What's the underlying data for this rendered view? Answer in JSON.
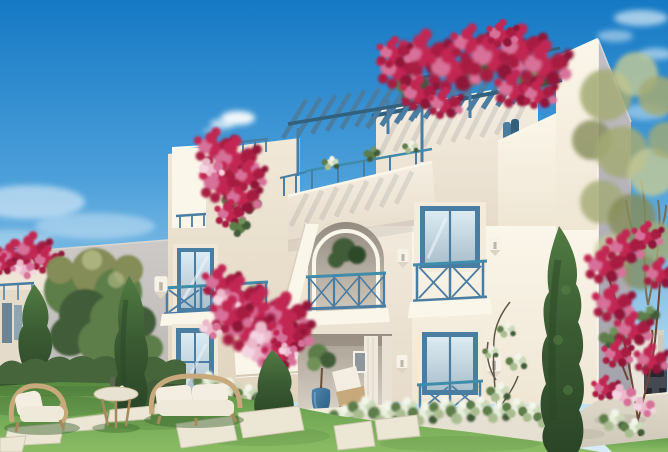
{
  "scene": {
    "type": "exterior-architectural-rendering",
    "subject": "White Cycladic-style two-storey residence with blue pergolas, bougainvillea, arched balcony, garden lawn, wicker seating and stepping-stone path under a clear blue sky",
    "elements": [
      "sky",
      "clouds",
      "neighbor-building-left",
      "neighbor-rooftop-pergola",
      "boundary-wall",
      "leafy-tree",
      "cypress-tree-left",
      "cypress-tree-center",
      "cypress-tree-right",
      "main-building",
      "rooftop-pergola",
      "terrace-pergola",
      "stair-tower",
      "arched-balcony",
      "balcony-railing",
      "upper-window-left",
      "entrance-door-left",
      "upper-window-right",
      "lower-window-right",
      "wall-lamps",
      "porch",
      "lounge-chair",
      "topiary-pot",
      "bougainvillea-rooftop",
      "bougainvillea-cascade",
      "bougainvillea-balcony",
      "bougainvillea-tree-right",
      "olive-tree-right",
      "climbing-vine",
      "flower-bed",
      "hedge",
      "lawn",
      "stepping-stones",
      "garden-armchair",
      "garden-side-table",
      "garden-sofa",
      "walkway",
      "background-wall-right",
      "parked-car"
    ],
    "palette": {
      "sky_top": "#1579c4",
      "sky_mid": "#4da0da",
      "sky_low": "#a6d2ec",
      "sky_horizon": "#d9ecf7",
      "cloud": "#ffffff",
      "wall_sun": "#f5eee1",
      "wall_bright": "#fbf6ea",
      "wall_warm": "#e7dccb",
      "wall_gray": "#bcb9b6",
      "wall_side": "#a3a1a9",
      "accent_blue": "#4a7da2",
      "accent_blue_dark": "#32617f",
      "accent_teal": "#3f8cab",
      "glass_light": "#dcebf2",
      "glass_mid": "#abc0cd",
      "glass_dark": "#6c8494",
      "flower_main": "#c22553",
      "flower_deep": "#a81b42",
      "flower_dark": "#8f1538",
      "flower_light": "#d8719a",
      "flower_pale": "#ecb8cb",
      "leaf_green": "#5d7d49",
      "leaf_dark": "#3f5c37",
      "olive": "#a3aa74",
      "olive_light": "#c6cb96",
      "olive_dark": "#848c58",
      "cypress": "#3b5c33",
      "cypress_dark": "#2b4527",
      "cypress_light": "#517c43",
      "lawn": "#6ea452",
      "lawn_light": "#8abc64",
      "lawn_dark": "#578a40",
      "shadow_green": "#3a632e",
      "hedge": "#47653b",
      "hedge_dark": "#334d2c",
      "stone": "#ece6d4",
      "stone_shade": "#cfc7b2",
      "path": "#d9d3c5",
      "wicker": "#c7a97c",
      "wicker_dark": "#a8895c",
      "cushion": "#f3eee1",
      "pot_blue": "#3c76a0",
      "porch_shade": "#a99f93",
      "porch_floor": "#d8d1c5",
      "car_body": "#454a52",
      "car_dark": "#24282e",
      "trunk": "#7a6f52",
      "stem": "#5f5848"
    }
  }
}
